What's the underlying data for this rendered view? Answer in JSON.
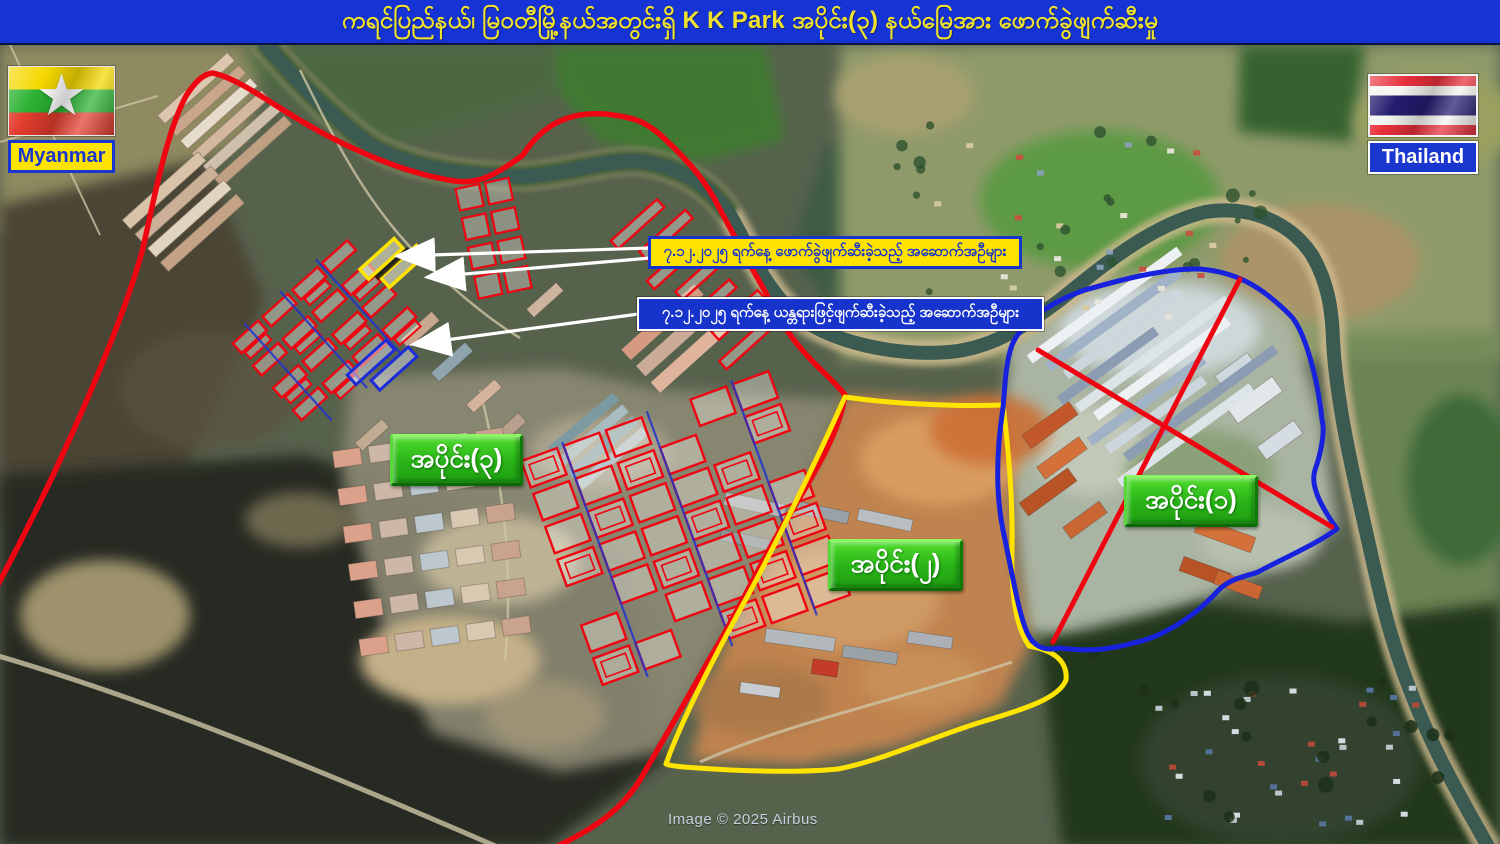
{
  "title": {
    "text": "ကရင်ပြည်နယ်၊ မြဝတီမြို့နယ်အတွင်းရှိ  K K Park အပိုင်း(၃) နယ်မြေအား ဖောက်ခွဲဖျက်ဆီးမှု"
  },
  "flags": {
    "myanmar": {
      "label": "Myanmar"
    },
    "thailand": {
      "label": "Thailand"
    }
  },
  "callouts": [
    {
      "id": "blast-demolished",
      "text": "၇.၁၂.၂၀၂၅ ရက်နေ့ ဖောက်ခွဲဖျက်ဆီးခဲ့သည့် အဆောက်အဦများ"
    },
    {
      "id": "machine-demolished",
      "text": "၇.၁၂.၂၀၂၅ ရက်နေ့ ယန္တရားဖြင့်ဖျက်ဆီးခဲ့သည့် အဆောက်အဦများ"
    }
  ],
  "section_labels": [
    {
      "id": "section-3",
      "text": "အပိုင်း(၃)"
    },
    {
      "id": "section-2",
      "text": "အပိုင်း(၂)"
    },
    {
      "id": "section-1",
      "text": "အပိုင်း(၁)"
    }
  ],
  "attribution": "Image © 2025 Airbus",
  "colors": {
    "titlebar_bg": "#1634d6",
    "title_text": "#f0e22a",
    "boundary_red": "#ee0511",
    "boundary_yellow": "#ffe400",
    "boundary_blue": "#1822dd",
    "cross_out_red": "#ee0511",
    "section_label_green": "#2cb81c",
    "callout1_bg": "#ffe300",
    "callout1_text": "#1633cc",
    "callout2_bg": "#1633cc",
    "callout2_text": "#ffffff",
    "building_outline_red": "#ee0511",
    "highlight_outline_yellow": "#ffe400",
    "highlight_outline_blue": "#1c2cd8",
    "arrow_white": "#ffffff"
  }
}
